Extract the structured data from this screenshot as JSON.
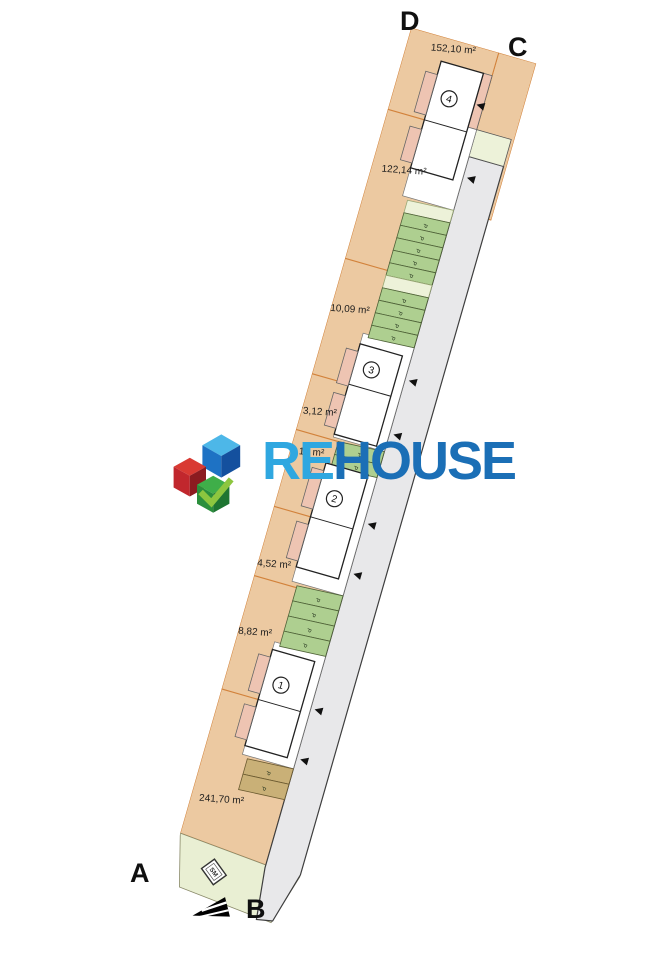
{
  "plan": {
    "corner_labels": {
      "top_left": "D",
      "top_right": "C",
      "bottom_left": "A",
      "bottom_right": "B"
    },
    "parcels": [
      {
        "area_label": "152,10 m²"
      },
      {
        "area_label": "122,14 m²"
      },
      {
        "area_label": "110,09 m²"
      },
      {
        "area_label": "73,12 m²"
      },
      {
        "area_label": "78,14 m²"
      },
      {
        "area_label": "94,52 m²"
      },
      {
        "area_label": "118,82 m²"
      },
      {
        "area_label": "241,70 m²"
      }
    ],
    "buildings": [
      {
        "number": "1"
      },
      {
        "number": "2"
      },
      {
        "number": "3"
      },
      {
        "number": "4"
      }
    ],
    "parking_space_label": "P",
    "utility_label": "SM",
    "colors": {
      "parcel_fill": "#ecc9a1",
      "parcel_line": "#d2823b",
      "parking_green": "#aecf90",
      "parking_pale": "#edf2d9",
      "parking_khaki": "#c9b077",
      "road_fill": "#e8e8ea",
      "building_annex": "#eec4b2",
      "lawn": "#e9efd3"
    }
  },
  "watermark": {
    "brand_prefix": "RE",
    "brand_suffix": "HOUSE",
    "prefix_color": "#2fa7e0",
    "suffix_color": "#1b6fb6"
  }
}
